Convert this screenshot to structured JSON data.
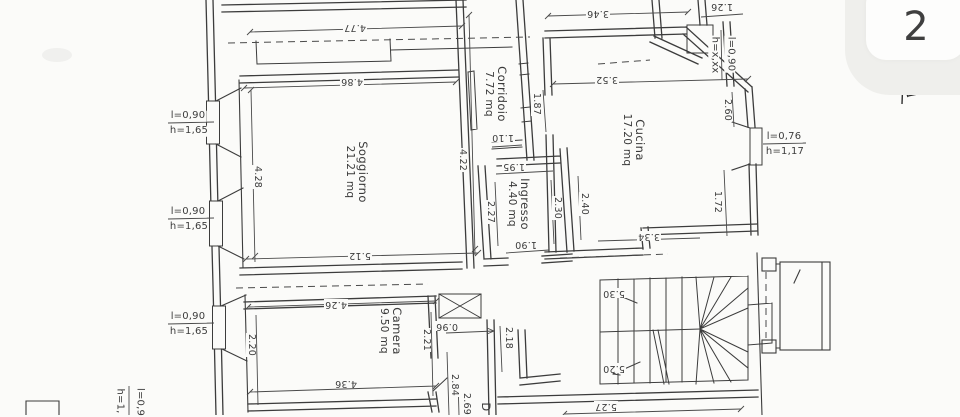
{
  "page": {
    "number": "2"
  },
  "rooms": {
    "soggiorno": {
      "name": "Soggiorno",
      "area": "21.21 mq"
    },
    "corridoio": {
      "name": "Corridoio",
      "area": "7.72 mq"
    },
    "cucina": {
      "name": "Cucina",
      "area": "17.20 mq"
    },
    "ingresso": {
      "name": "Ingresso",
      "area": "4.40 mq"
    },
    "camera": {
      "name": "Camera",
      "area": "9.50 mq"
    },
    "partial": {
      "name": "D"
    }
  },
  "dimensions": {
    "d4_77": "4.77",
    "d4_86": "4.86",
    "d3_46": "3.46",
    "d3_52": "3.52",
    "d1_26": "1.26",
    "d4_28": "4.28",
    "d4_22": "4.22",
    "d1_87": "1.87",
    "d2_60": "2.60",
    "d1_72": "1.72",
    "d3_34": "3.34",
    "d1_10": "1.10",
    "d1_95": "1.95",
    "d2_27": "2.27",
    "d2_30": "2.30",
    "d2_40": "2.40",
    "d1_90": "1.90",
    "d5_12": "5.12",
    "d4_26": "4.26",
    "d2_20": "2.20",
    "d2_21": "2.21",
    "d0_96": "0.96",
    "d4_36": "4.36",
    "d2_84": "2.84",
    "d2_69": "2.69",
    "d2_18": "2.18",
    "d5_30": "5.30",
    "d5_20": "5.20",
    "d5_27": "5.27"
  },
  "windows": {
    "left1": {
      "l": "l=0,90",
      "h": "h=1,65"
    },
    "left2": {
      "l": "l=0,90",
      "h": "h=1,65"
    },
    "left3": {
      "l": "l=0,90",
      "h": "h=1,65"
    },
    "right": {
      "l": "l=0,76",
      "h": "h=1,17"
    },
    "top": {
      "l": "l=0,90",
      "h": "h=x,xx"
    },
    "bottom": {
      "l": "l=0,9",
      "h": "h=1,"
    }
  },
  "colors": {
    "ink": "#3c3c3c",
    "paper": "#fbfbf9"
  }
}
